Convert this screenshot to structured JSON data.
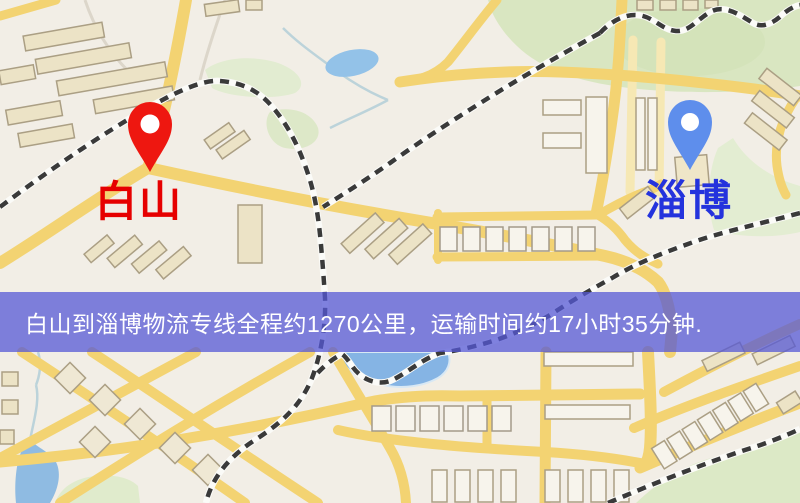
{
  "map": {
    "markers": [
      {
        "id": "origin",
        "label": "白山",
        "pin": "red-map-pin",
        "pin_color": "#ee1710",
        "label_color": "#e60000"
      },
      {
        "id": "destination",
        "label": "淄博",
        "pin": "blue-map-pin",
        "pin_color": "#5e8eec",
        "label_color": "#2433dd"
      }
    ]
  },
  "banner": {
    "text": "白山到淄博物流专线全程约1270公里，运输时间约17小时35分钟.",
    "origin": "白山",
    "destination": "淄博",
    "distance_km": "1270",
    "duration_hours": "17",
    "duration_minutes": "35"
  },
  "colors": {
    "label-red": "#e60000",
    "label-blue": "#2433dd",
    "banner-text": "#ffffff",
    "banner-bg": "#5658d6",
    "map-road-yellow": "#f3d372",
    "map-water-blue": "#8fbbe2",
    "map-green": "#d9e6c1"
  }
}
